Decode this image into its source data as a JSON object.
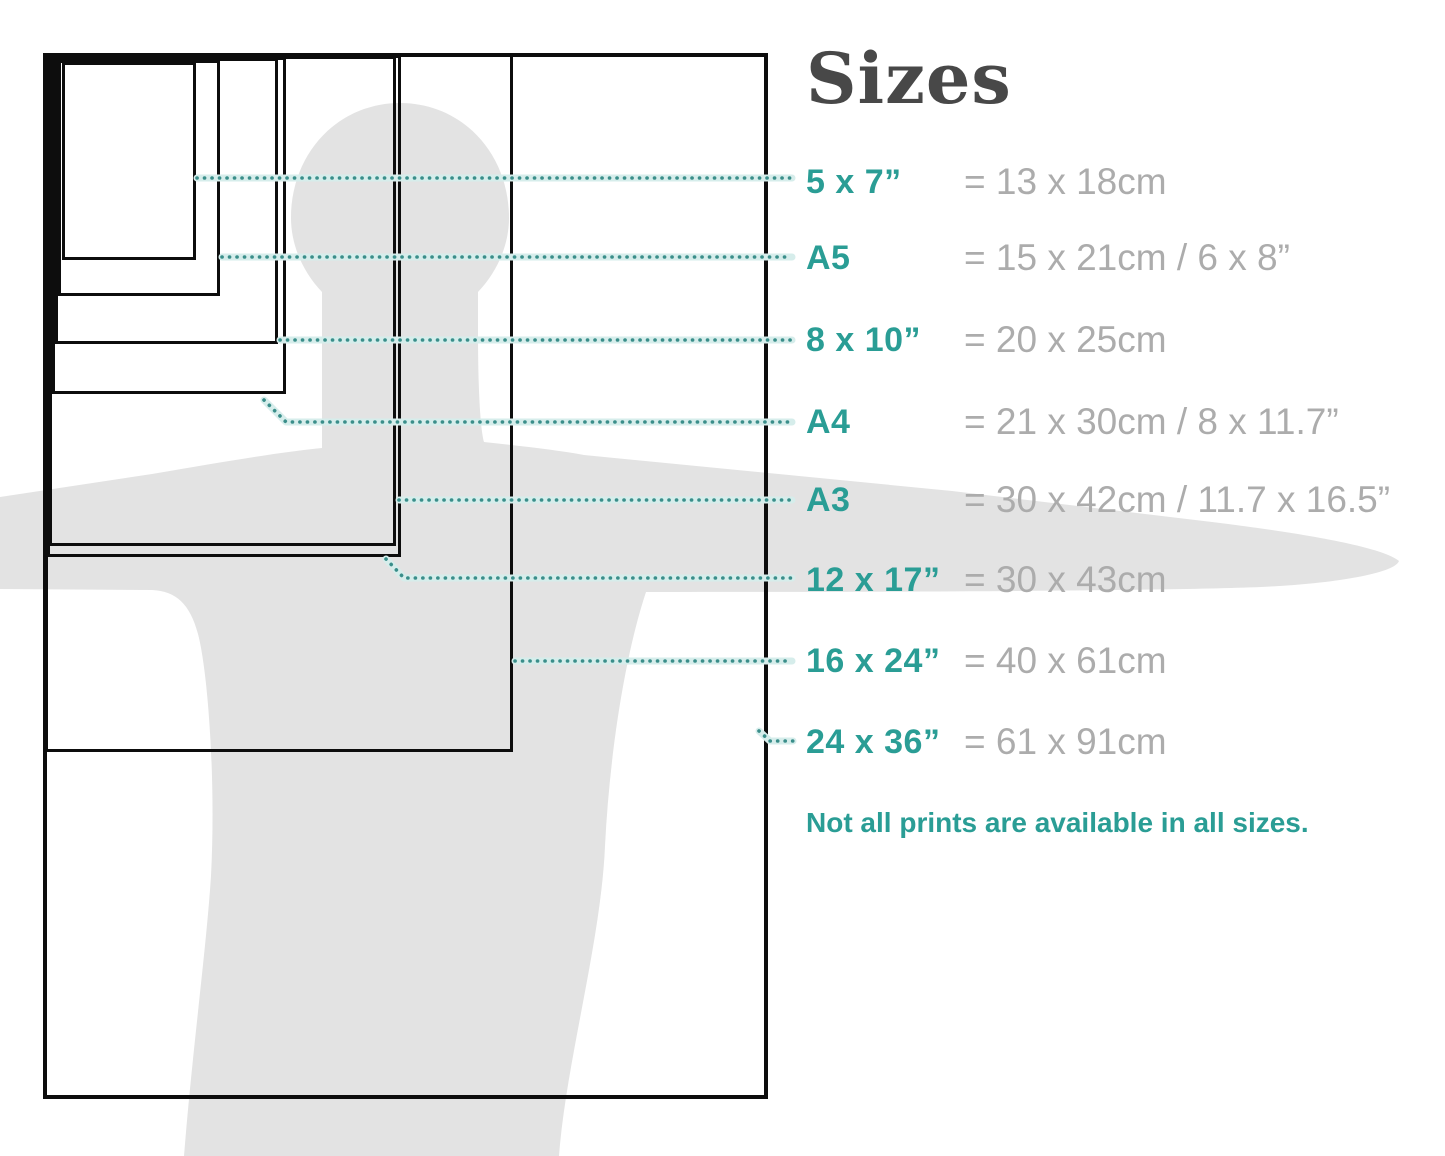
{
  "title": "Sizes",
  "note": "Not all prints are available in all sizes.",
  "colors": {
    "accent": "#2A9D95",
    "value_text": "#ACACAC",
    "title_text": "#484848",
    "silhouette": "#E3E3E3",
    "leader_dot": "#3A8E8A",
    "leader_halo": "#D6EDEB",
    "box_border": "#0D0D0D"
  },
  "sizes": [
    {
      "id": "5x7",
      "label": "5 x 7”",
      "metric": "= 13 x 18cm",
      "box": {
        "x": 62,
        "y": 62,
        "w": 134,
        "h": 198
      },
      "leader": [
        [
          197,
          178
        ],
        [
          792,
          178
        ]
      ],
      "row_y": 182
    },
    {
      "id": "a5",
      "label": "A5",
      "metric": "= 15 x 21cm / 6 x 8”",
      "box": {
        "x": 58,
        "y": 60,
        "w": 162,
        "h": 236
      },
      "leader": [
        [
          222,
          257
        ],
        [
          792,
          257
        ]
      ],
      "row_y": 258
    },
    {
      "id": "8x10",
      "label": "8 x 10”",
      "metric": "= 20 x 25cm",
      "box": {
        "x": 55,
        "y": 58,
        "w": 223,
        "h": 286
      },
      "leader": [
        [
          280,
          340
        ],
        [
          792,
          340
        ]
      ],
      "row_y": 340
    },
    {
      "id": "a4",
      "label": "A4",
      "metric": "= 21 x 30cm / 8 x 11.7”",
      "box": {
        "x": 52,
        "y": 57,
        "w": 234,
        "h": 337
      },
      "leader": [
        [
          264,
          400
        ],
        [
          286,
          422
        ],
        [
          792,
          422
        ]
      ],
      "row_y": 422
    },
    {
      "id": "a3",
      "label": "A3",
      "metric": "= 30 x 42cm / 11.7 x 16.5”",
      "box": {
        "x": 49,
        "y": 56,
        "w": 347,
        "h": 490
      },
      "leader": [
        [
          399,
          500
        ],
        [
          792,
          500
        ]
      ],
      "row_y": 500
    },
    {
      "id": "12x17",
      "label": "12 x 17”",
      "metric": "= 30 x 43cm",
      "box": {
        "x": 47,
        "y": 55,
        "w": 354,
        "h": 502
      },
      "leader": [
        [
          386,
          559
        ],
        [
          404,
          578
        ],
        [
          792,
          578
        ]
      ],
      "row_y": 580
    },
    {
      "id": "16x24",
      "label": "16 x 24”",
      "metric": "= 40 x 61cm",
      "box": {
        "x": 45,
        "y": 54,
        "w": 468,
        "h": 698
      },
      "leader": [
        [
          515,
          661
        ],
        [
          792,
          661
        ]
      ],
      "row_y": 661
    },
    {
      "id": "24x36",
      "label": "24 x 36”",
      "metric": "= 61 x 91cm",
      "box": {
        "x": 43,
        "y": 53,
        "w": 725,
        "h": 1046
      },
      "leader": [
        [
          759,
          731
        ],
        [
          770,
          741
        ],
        [
          793,
          741
        ]
      ],
      "row_y": 742
    }
  ]
}
